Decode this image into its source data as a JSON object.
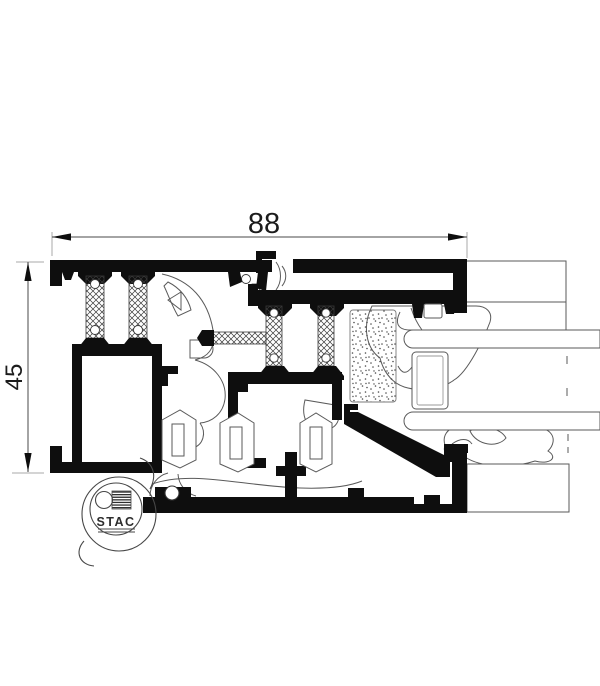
{
  "dimensions": {
    "width_label": "88",
    "height_label": "45"
  },
  "logo": {
    "brand": "STAC"
  },
  "colors": {
    "background": "#ffffff",
    "profile_fill": "#0e0e0e",
    "thin_line": "#5a5a5a",
    "extension_line": "#a8a8a8",
    "dimension_line": "#4a4a4a",
    "text": "#1c1c1c",
    "hatch": "#3a3a3a",
    "stipple_dot": "#4a4a4a"
  }
}
